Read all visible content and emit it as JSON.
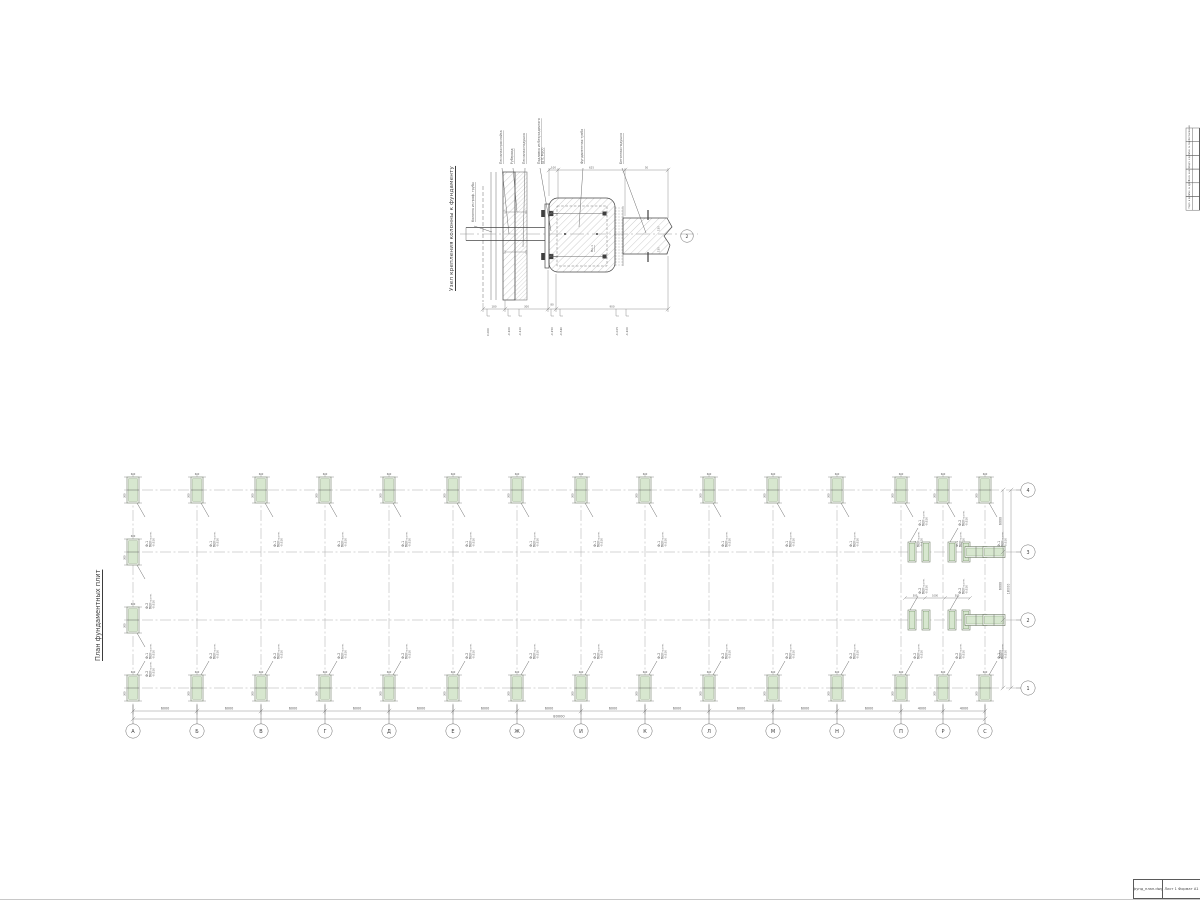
{
  "sheet": {
    "background": "#ffffff",
    "ink": "#474747",
    "dim_color": "#6e6e6e",
    "green_fill": "#d7e7cf",
    "green_stroke": "#7c9a6d"
  },
  "detail": {
    "title": "Узел крепления колонны к фундаменту",
    "callouts": [
      "Колонна из проф. трубы",
      "Песчаная прослойка",
      "Рубероид",
      "Песчаная подушка",
      "Подливка из безусадочного ЦПС М300",
      "Фундаментная тумба",
      "Бетонная подушка"
    ],
    "part_label": "Пк-1",
    "section_mark": "2",
    "dims_top": [
      "100",
      "625",
      "50"
    ],
    "dims_bottom": [
      "180",
      "300",
      "80",
      "900"
    ],
    "dims_right": [
      "150",
      "150"
    ],
    "elevations": [
      "0.000",
      "-0.100",
      "-0.120",
      "-0.150",
      "-0.640",
      "-1.025",
      "-1.100"
    ]
  },
  "plan": {
    "title": "План фундаментных плит",
    "bottom_axis_labels": [
      "А",
      "Б",
      "В",
      "Г",
      "Д",
      "Е",
      "Ж",
      "И",
      "К",
      "Л",
      "М",
      "Н",
      "П",
      "Р",
      "С"
    ],
    "right_axis_labels": [
      "4",
      "3",
      "2",
      "1"
    ],
    "bay_dims_bottom": [
      "6000",
      "6000",
      "6000",
      "6000",
      "6000",
      "6000",
      "6000",
      "6000",
      "6000",
      "6000",
      "6000",
      "6000",
      "4000",
      "4000"
    ],
    "total_bottom": "80000",
    "bay_dims_right": [
      "6000",
      "6000",
      "6000"
    ],
    "total_right": "18000",
    "footing_micro_dims": [
      "300",
      "600"
    ],
    "cluster_dims": [
      "500",
      "1000",
      "500"
    ],
    "footings": {
      "f1": {
        "mark": "Ф-1",
        "note": "Верх на отм.",
        "elev": "-0.620"
      },
      "f2": {
        "mark": "Ф-2",
        "note": "Верх на отм.",
        "elev": "-0.620"
      }
    }
  },
  "frame": {
    "side_column_labels": [
      "Согласовано",
      "Инв. № подл.",
      "Подп. и дата",
      "Взам. инв. №",
      "Инв. № дубл.",
      "Подп. и дата"
    ],
    "footer_cells": [
      "фунд_план.dwg",
      "Лист 1  Формат А1"
    ]
  }
}
